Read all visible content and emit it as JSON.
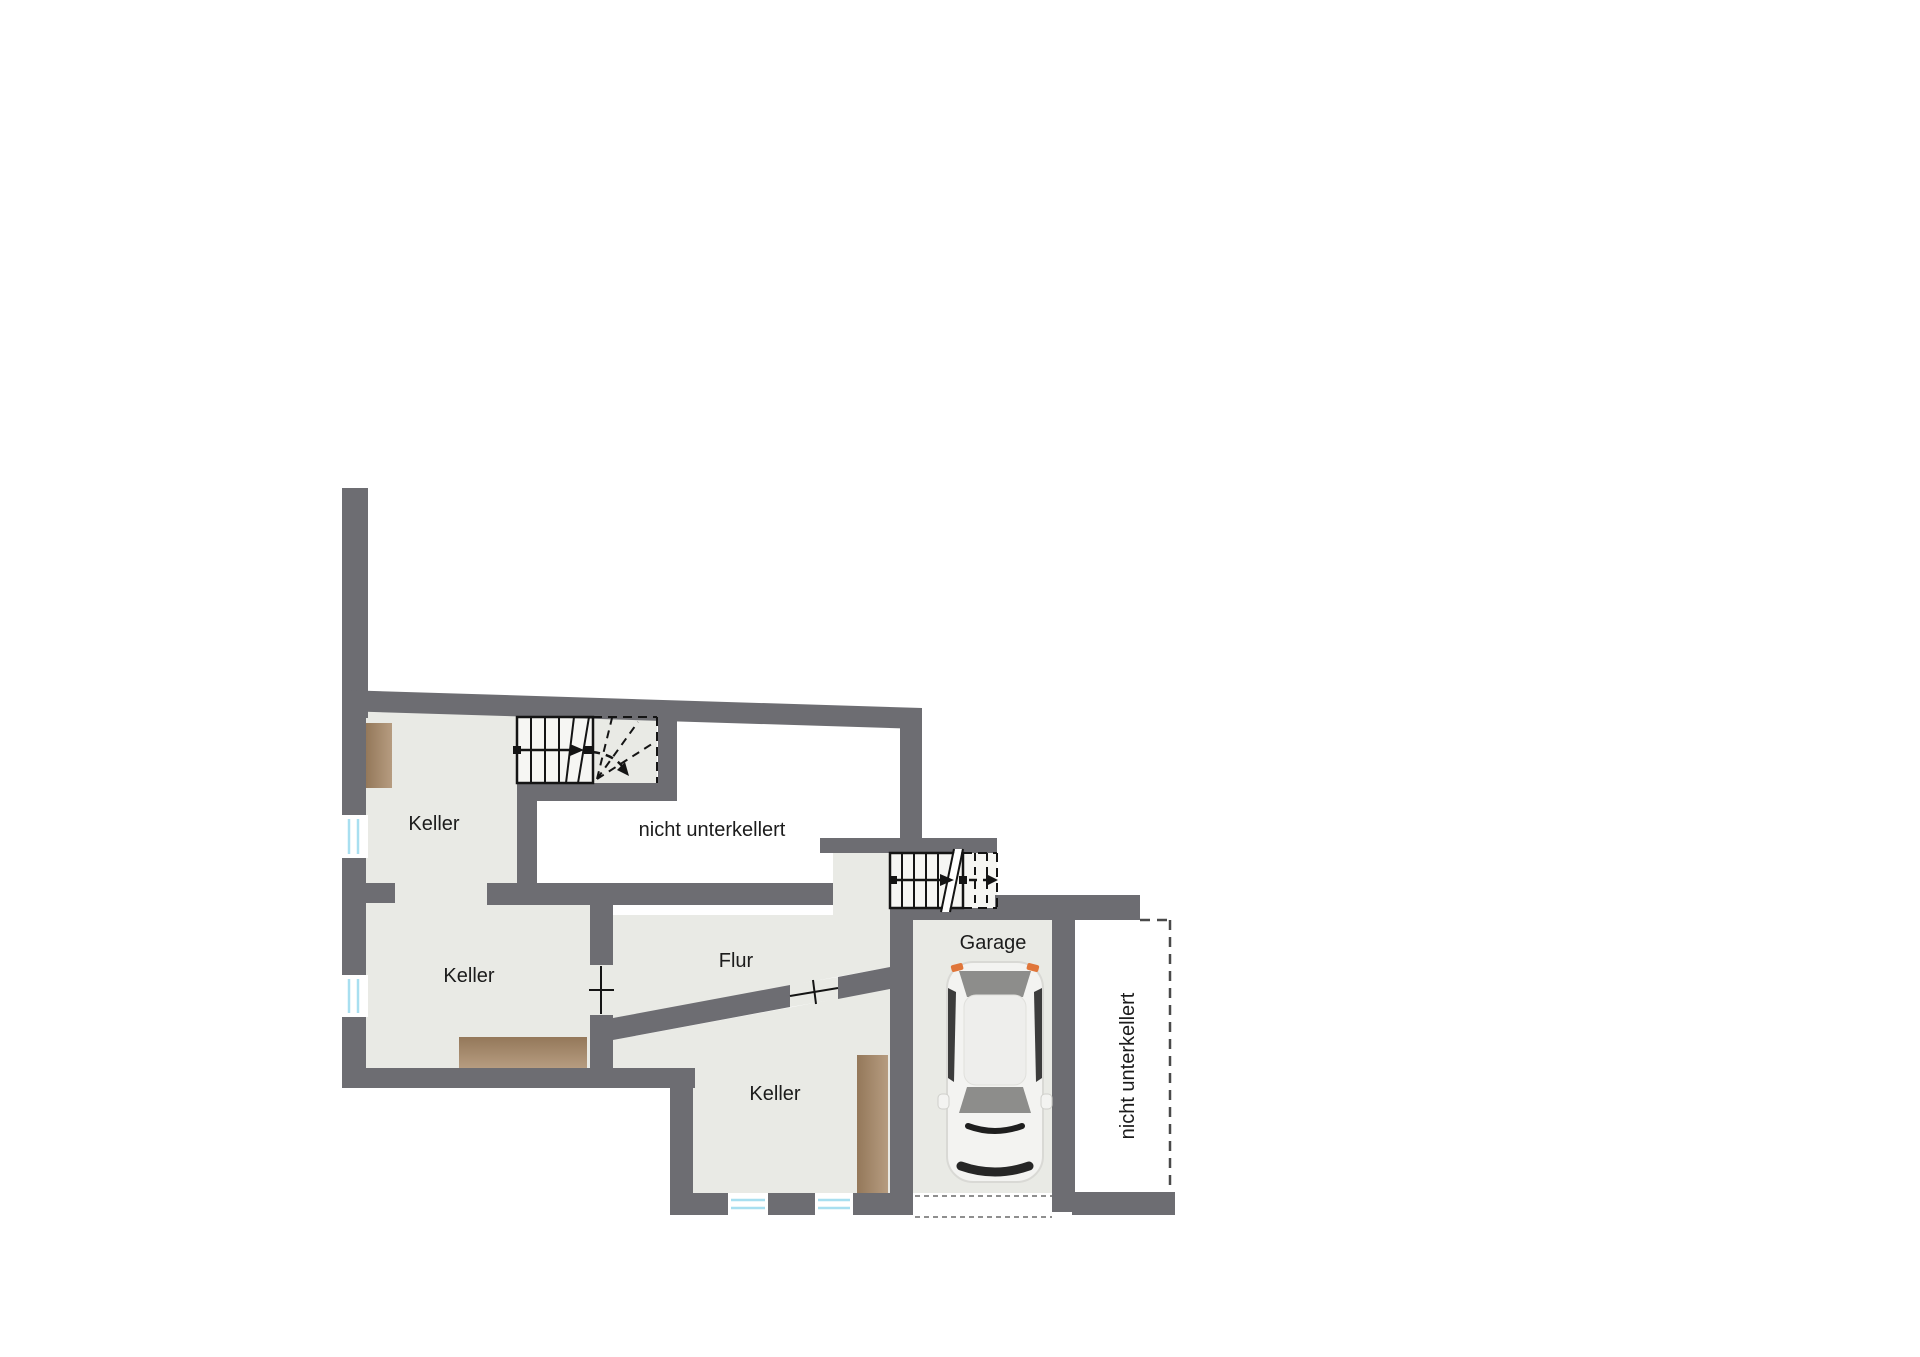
{
  "floorplan": {
    "rooms": [
      {
        "id": "keller-top",
        "label": "Keller"
      },
      {
        "id": "keller-middle",
        "label": "Keller"
      },
      {
        "id": "keller-bottom",
        "label": "Keller"
      },
      {
        "id": "flur",
        "label": "Flur"
      },
      {
        "id": "garage",
        "label": "Garage"
      },
      {
        "id": "no-basement-top",
        "label": "nicht unterkellert"
      },
      {
        "id": "no-basement-right",
        "label": "nicht unterkellert"
      }
    ],
    "colors": {
      "wall": "#6d6d72",
      "floor": "#e9eae5",
      "stair": "#f6f6f3",
      "wood_dark": "#94785a",
      "wood_light": "#b69c80",
      "window": "#a8dff0",
      "line": "#141414",
      "text": "#1c1c1c",
      "car_body": "#f3f3f1",
      "car_glass": "#8d8d8b",
      "car_dark": "#3c3c3c",
      "taillight": "#e0763a",
      "dash": "#4a4a4a"
    }
  }
}
